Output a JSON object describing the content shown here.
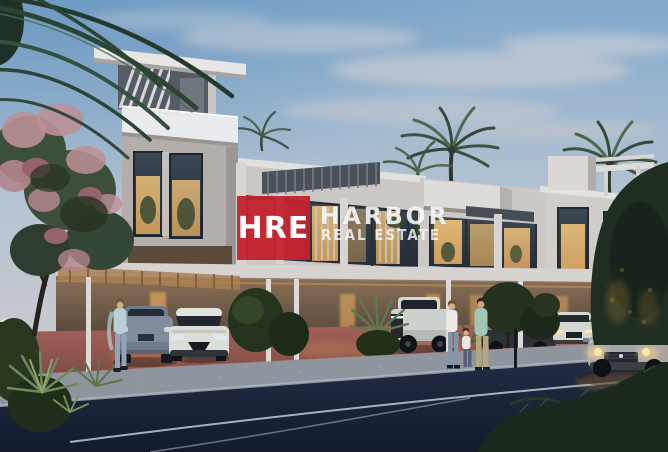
{
  "watermark": {
    "logo_text": "HRE",
    "brand_name": "HARBOR",
    "brand_suffix": "REAL ESTATE",
    "logo_color": "#c3222f",
    "text_color": "#ffffff"
  },
  "colors": {
    "sky_top": "#82a8cb",
    "sky_mid": "#b6c4d2",
    "sky_horizon": "#d6cccb",
    "cloud": "#e0d8d8",
    "wall_light": "#d6d3d0",
    "wall_mid": "#c9c5c2",
    "wall_dark": "#4b515b",
    "glass_dark": "#323d49",
    "window_glow": "#e2a95f",
    "carport_glow": "#8a6f56",
    "driveway_pink": "#a4625a",
    "sidewalk_grey": "#8f959e",
    "road_dark": "#222c44",
    "road_line": "#ccd4dc",
    "foliage_dark": "#243221",
    "foliage_light": "#5d7a4e",
    "flower_pink": "#bd8f97",
    "palm_green": "#3d5340",
    "car_grey_blue": "#7f8d9c",
    "car_white": "#dcddd8",
    "car_silver": "#a3a7ad",
    "headlight_glow": "#ffd98e"
  },
  "scene": {
    "setting": "Twilight rendering of a modern townhouse complex",
    "elements": [
      "palm trees",
      "pink flowering tree",
      "louvered roof tower",
      "lit floor-to-ceiling windows",
      "carport colonnade",
      "grey hatchback",
      "white compact suv",
      "white pickup truck",
      "dark sedan",
      "white suv",
      "silver suv driving with headlights on",
      "woman by car",
      "family of three walking",
      "street with white lane markings"
    ]
  }
}
